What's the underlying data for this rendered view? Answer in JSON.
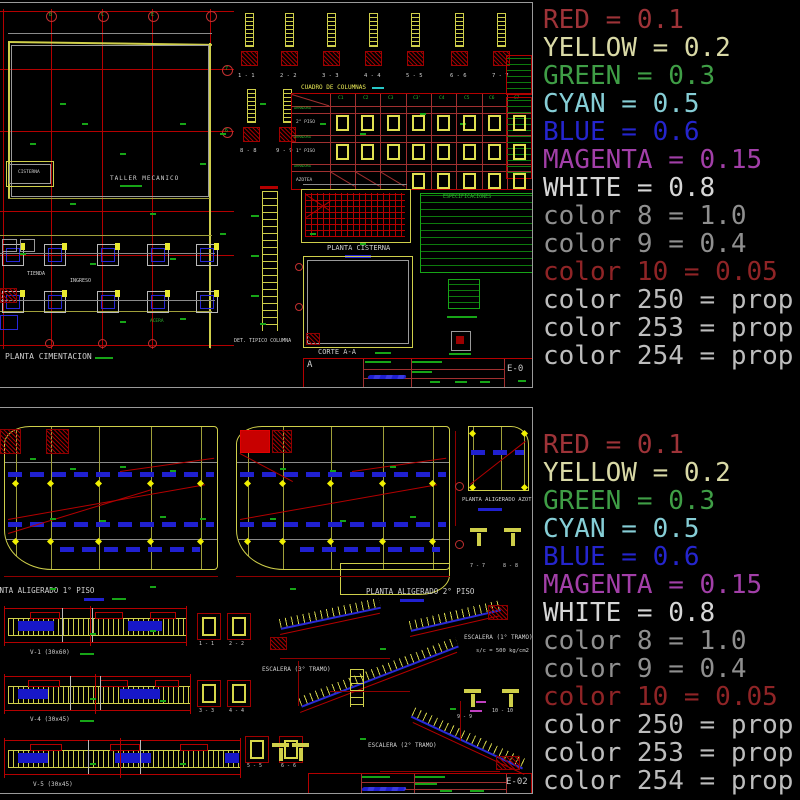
{
  "legend": {
    "entries": [
      {
        "text": "RED = 0.1",
        "color": "#9e3338"
      },
      {
        "text": "YELLOW = 0.2",
        "color": "#d9d9a6"
      },
      {
        "text": "GREEN = 0.3",
        "color": "#3f9e46"
      },
      {
        "text": "CYAN = 0.5",
        "color": "#86ced6"
      },
      {
        "text": "BLUE = 0.6",
        "color": "#2525cd"
      },
      {
        "text": "MAGENTA = 0.15",
        "color": "#a23fa8"
      },
      {
        "text": "WHITE = 0.8",
        "color": "#d6d6d6"
      },
      {
        "text": "color 8 = 1.0",
        "color": "#8f8f8f"
      },
      {
        "text": "color 9 = 0.4",
        "color": "#8f8f8f"
      },
      {
        "text": "color 10 = 0.05",
        "color": "#8f2426"
      },
      {
        "text": "color 250 = prop",
        "color": "#bdbdbd"
      },
      {
        "text": "color 253 = prop",
        "color": "#bdbdbd"
      },
      {
        "text": "color 254 = prop",
        "color": "#bdbdbd"
      }
    ]
  },
  "top": {
    "labels": {
      "taller": "TALLER MECANICO",
      "cisterna": "CISTERNA",
      "tienda": "TIENDA",
      "ingreso": "INGRESO",
      "acera": "ACERA",
      "planta_cimentacion": "PLANTA CIMENTACION",
      "cuadro_columnas": "CUADRO DE COLUMNAS",
      "col_headers": [
        "C1",
        "C2",
        "C3",
        "C3'",
        "C4",
        "C5",
        "C6",
        "C7"
      ],
      "armadura": "ARMADURA",
      "piso_rows": [
        "2° PISO",
        "1° PISO",
        "AZOTEA"
      ],
      "sections_row1": [
        "1 - 1",
        "2 - 2",
        "3 - 3",
        "4 - 4",
        "5 - 5",
        "6 - 6",
        "7 - 7"
      ],
      "sections_row2": [
        "8 - 8",
        "9 - 9"
      ],
      "planta_cisterna": "PLANTA CISTERNA",
      "especificaciones": "ESPECIFICACIONES",
      "det_tipico": "DET. TIPICO COLUMNA",
      "corte": "CORTE A-A",
      "axis_top": [
        "B",
        "C",
        "E"
      ],
      "axis_right": [
        "7",
        "6"
      ],
      "sheet_letter": "A",
      "sheet_no": "E-0"
    }
  },
  "bottom": {
    "labels": {
      "planta1": "PLANTA ALIGERADO 1° PISO",
      "planta2": "PLANTA ALIGERADO 2° PISO",
      "azotea": "PLANTA ALIGERADO AZOTEA",
      "beams": [
        "V-1 (30x60)",
        "V-4 (30x45)",
        "V-5 (30x45)"
      ],
      "beam_sections": [
        "1 - 1",
        "2 - 2",
        "3 - 3",
        "4 - 4",
        "5 - 5",
        "6 - 6"
      ],
      "azotea_sections": [
        "7 - 7",
        "8 - 8"
      ],
      "stair_sections": [
        "9 - 9",
        "10 - 10"
      ],
      "escalera1": "ESCALERA (1° TRAMO)",
      "escalera1_sub": "s/c = 500 kg/cm2",
      "escalera2": "ESCALERA (2° TRAMO)",
      "escalera3": "ESCALERA (3° TRAMO)",
      "sheet_no": "E-02"
    }
  }
}
